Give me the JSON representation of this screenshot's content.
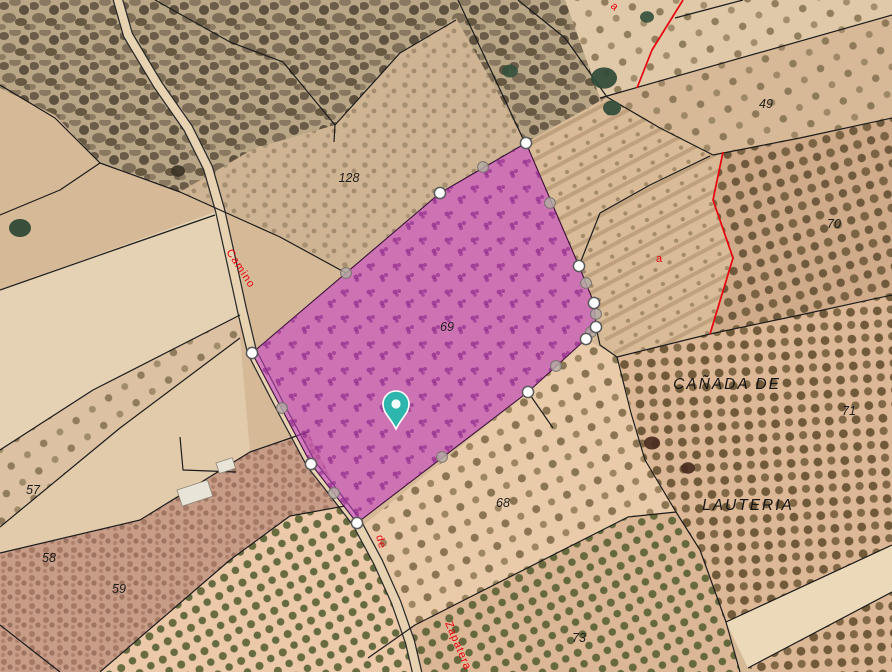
{
  "map": {
    "width": 892,
    "height": 672,
    "colors": {
      "base": "#d6b997",
      "boundary": "#1c1c1c",
      "red_boundary": "#e8000d",
      "road_fill": "#e7d3b2",
      "road_casing": "#2a2a2a",
      "parcel_fill": "rgba(199,62,199,0.58)",
      "parcel_stroke": "#3a1238",
      "vertex_fill": "#ffffff",
      "vertex_stroke": "#5a5a5a",
      "midpoint_fill": "rgba(181,172,166,0.82)",
      "midpoint_stroke": "#7a746e",
      "pin_color": "#2cb6ae"
    },
    "fields": [
      {
        "name": "scrub-main",
        "fill": "#b9a687",
        "pattern": "pat-scrub",
        "points": "0,0 565,0 607,97 525,143 440,193 346,273 280,237 180,192 100,163 55,115 0,88"
      },
      {
        "name": "strip-128",
        "fill": "#cfb494",
        "pattern": "pat-mottle-light",
        "points": "456,18 525,142 440,193 346,273 280,237 180,192 255,148 335,125 400,53"
      },
      {
        "name": "field-top-right",
        "fill": "#e0c9a8",
        "pattern": "pat-olive-sparse",
        "points": "565,0 892,0 892,15 600,98"
      },
      {
        "name": "field-49",
        "fill": "#d7b997",
        "pattern": "pat-olive-sparse",
        "points": "600,98 892,15 892,118 713,155 660,128 607,97"
      },
      {
        "name": "field-terrace-a",
        "fill": "#d9bb98",
        "pattern": "pat-rows",
        "points": "607,97 713,155 723,152 713,200 733,258 710,334 617,357 596,327 594,303 579,266 550,203 526,143"
      },
      {
        "name": "field-70",
        "fill": "#d0ab8a",
        "pattern": "pat-olive-dense",
        "points": "713,155 892,118 892,295 710,334 733,258 713,200 723,152"
      },
      {
        "name": "field-canada",
        "fill": "#ddb897",
        "pattern": "pat-olive-dense2",
        "points": "617,357 710,334 892,295 892,545 726,622 700,550 645,460"
      },
      {
        "name": "strip-track",
        "fill": "#ecd9ba",
        "pattern": null,
        "points": "726,622 892,545 892,592 748,668"
      },
      {
        "name": "field-lauteria-corner",
        "fill": "#ddb897",
        "pattern": "pat-olive-dense2",
        "points": "748,668 892,592 892,672 760,672"
      },
      {
        "name": "field-68",
        "fill": "#e9cba9",
        "pattern": "pat-olive-68",
        "points": "360,528 528,392 586,339 617,357 645,460 676,512 628,517 415,625 368,656"
      },
      {
        "name": "field-73",
        "fill": "#dcb795",
        "pattern": "pat-olive-green",
        "points": "368,656 415,625 628,517 676,512 700,550 726,622 740,672 420,672"
      },
      {
        "name": "strip-nw-pale",
        "fill": "#e5d2b4",
        "pattern": null,
        "points": "0,290 215,212 232,255 240,315 93,390 0,450"
      },
      {
        "name": "strip-57",
        "fill": "#dcc2a3",
        "pattern": "pat-olive-sparse",
        "points": "0,450 93,390 240,315 240,338 120,428 0,527"
      },
      {
        "name": "strip-58",
        "fill": "#e2cbab",
        "pattern": null,
        "points": "0,527 120,428 240,338 250,452 140,520 0,553"
      },
      {
        "name": "strip-59",
        "fill": "#c79d87",
        "pattern": "pat-mottle-dark",
        "points": "0,553 140,520 250,452 308,432 345,506 290,516 230,560 100,672 0,672"
      },
      {
        "name": "field-bl-olive",
        "fill": "#ecc9a8",
        "pattern": "pat-olive-green",
        "points": "100,672 230,560 290,516 345,506 368,540 395,600 410,642 417,672"
      }
    ],
    "road": {
      "name": "camino-track",
      "points": "118,0 128,35 158,85 188,128 208,168 220,210 230,255 242,310 252,352 282,410 311,464 334,493 357,523 378,562 396,602 410,642 417,672"
    },
    "boundaries": [
      "0,85 55,118 100,163",
      "100,163 60,190 0,215",
      "100,163 180,192 280,237 346,273",
      "155,0 230,42 283,62 335,125",
      "335,125 400,53 456,20",
      "335,125 334,142",
      "458,0 525,143",
      "518,0 565,38 607,97 660,128 713,155",
      "600,98 892,15",
      "713,155 800,138 892,118",
      "600,213 650,185 710,156",
      "675,18 743,0",
      "600,213 579,266",
      "892,295 800,315 710,334 617,357",
      "617,357 600,345 596,327",
      "617,357 631,413 645,460 676,512 700,550 726,622 740,672",
      "726,622 892,545",
      "748,668 892,592",
      "676,512 628,517 415,625 368,658",
      "0,290 120,248 215,215",
      "240,315 93,390 0,450",
      "0,527 120,428 240,338",
      "0,553 140,520 250,452 308,432",
      "100,672 230,560 290,516 345,506",
      "0,625 60,672",
      "180,437 183,470 236,472",
      "528,392 553,428"
    ],
    "red_lines": [
      "683,0 652,50 637,88",
      "723,152 713,200 733,258 710,334"
    ],
    "selected_parcel": {
      "points": "526,143 579,266 594,303 596,327 586,339 528,392 357,523 311,464 252,353 440,193",
      "vertices": [
        [
          526,
          143
        ],
        [
          579,
          266
        ],
        [
          594,
          303
        ],
        [
          596,
          327
        ],
        [
          586,
          339
        ],
        [
          528,
          392
        ],
        [
          357,
          523
        ],
        [
          311,
          464
        ],
        [
          252,
          353
        ],
        [
          440,
          193
        ]
      ],
      "midpoints": [
        [
          550,
          203
        ],
        [
          586,
          283
        ],
        [
          596,
          314
        ],
        [
          591,
          332
        ],
        [
          556,
          366
        ],
        [
          442,
          457
        ],
        [
          334,
          493
        ],
        [
          282,
          408
        ],
        [
          346,
          273
        ],
        [
          483,
          167
        ]
      ]
    },
    "pin": {
      "x": 396,
      "y": 404
    },
    "labels": {
      "parcel_numbers": [
        {
          "text": "128",
          "x": 349,
          "y": 182
        },
        {
          "text": "49",
          "x": 766,
          "y": 108
        },
        {
          "text": "70",
          "x": 834,
          "y": 228
        },
        {
          "text": "71",
          "x": 849,
          "y": 415
        },
        {
          "text": "69",
          "x": 447,
          "y": 331
        },
        {
          "text": "68",
          "x": 503,
          "y": 507
        },
        {
          "text": "57",
          "x": 33,
          "y": 494
        },
        {
          "text": "58",
          "x": 49,
          "y": 562
        },
        {
          "text": "59",
          "x": 119,
          "y": 593
        },
        {
          "text": "73",
          "x": 579,
          "y": 642
        }
      ],
      "place_names": [
        {
          "text": "CAÑADA  DE",
          "x": 727,
          "y": 389
        },
        {
          "text": "LAUTERIA",
          "x": 748,
          "y": 510
        }
      ],
      "road_names": [
        {
          "text": "Camino",
          "x": 226,
          "y": 252,
          "rot": 57
        },
        {
          "text": "de",
          "x": 376,
          "y": 536,
          "rot": 75
        },
        {
          "text": "Zapatera",
          "x": 445,
          "y": 623,
          "rot": 67
        },
        {
          "text": "a",
          "x": 656,
          "y": 262,
          "rot": 0
        },
        {
          "text": "a",
          "x": 610,
          "y": 7,
          "rot": 40
        }
      ]
    },
    "buildings": [
      {
        "x": 177,
        "y": 490,
        "w": 32,
        "h": 17,
        "rot": -18
      },
      {
        "x": 216,
        "y": 463,
        "w": 17,
        "h": 11,
        "rot": -18
      }
    ],
    "trees": [
      {
        "x": 604,
        "y": 78,
        "r": 13,
        "color": "#2f4a38"
      },
      {
        "x": 510,
        "y": 71,
        "r": 8,
        "color": "#35503c"
      },
      {
        "x": 612,
        "y": 108,
        "r": 9,
        "color": "#2f4a38"
      },
      {
        "x": 647,
        "y": 17,
        "r": 7,
        "color": "#35503c"
      },
      {
        "x": 20,
        "y": 228,
        "r": 11,
        "color": "#2c4434"
      },
      {
        "x": 178,
        "y": 171,
        "r": 7,
        "color": "#3a3325"
      },
      {
        "x": 652,
        "y": 443,
        "r": 8,
        "color": "#4a2d20"
      },
      {
        "x": 688,
        "y": 468,
        "r": 7,
        "color": "#4a2d20"
      }
    ]
  }
}
